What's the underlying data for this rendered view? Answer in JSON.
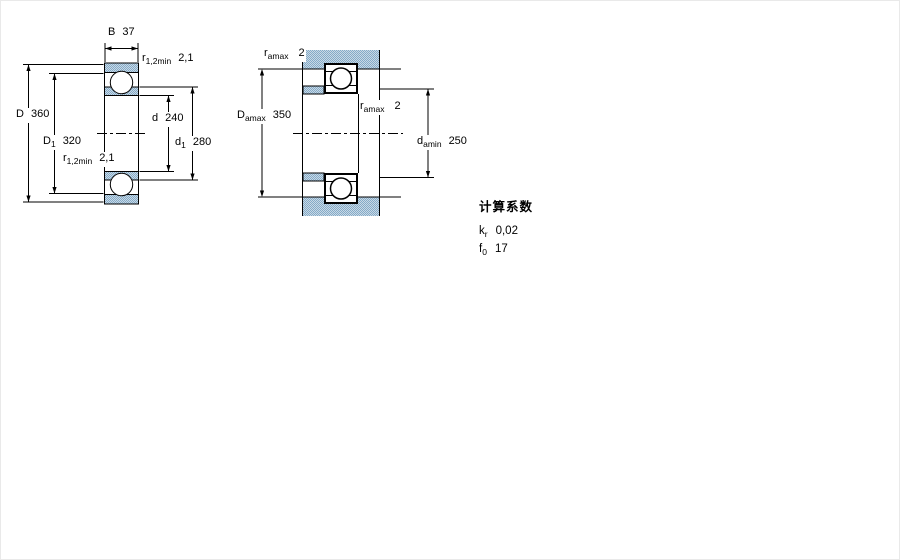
{
  "left_view": {
    "B": {
      "sym": "B",
      "sub": "",
      "value": "37"
    },
    "r_top": {
      "sym": "r",
      "sub": "1,2min",
      "value": "2,1"
    },
    "D": {
      "sym": "D",
      "sub": "",
      "value": "360"
    },
    "D1": {
      "sym": "D",
      "sub": "1",
      "value": "320"
    },
    "r_left": {
      "sym": "r",
      "sub": "1,2min",
      "value": "2,1"
    },
    "d": {
      "sym": "d",
      "sub": "",
      "value": "240"
    },
    "d1": {
      "sym": "d",
      "sub": "1",
      "value": "280"
    }
  },
  "right_view": {
    "ra_top": {
      "sym": "r",
      "sub": "amax",
      "value": "2"
    },
    "Da": {
      "sym": "D",
      "sub": "amax",
      "value": "350"
    },
    "ra_mid": {
      "sym": "r",
      "sub": "amax",
      "value": "2"
    },
    "da": {
      "sym": "d",
      "sub": "amin",
      "value": "250"
    }
  },
  "calculation_factors": {
    "title": "计算系数",
    "rows": [
      {
        "sym": "k",
        "sub": "r",
        "value": "0,02"
      },
      {
        "sym": "f",
        "sub": "0",
        "value": "17"
      }
    ]
  },
  "colors": {
    "hatch_dark": "#84aac8",
    "hatch_light": "#c9d9e5",
    "line": "#000000",
    "background": "#ffffff"
  }
}
